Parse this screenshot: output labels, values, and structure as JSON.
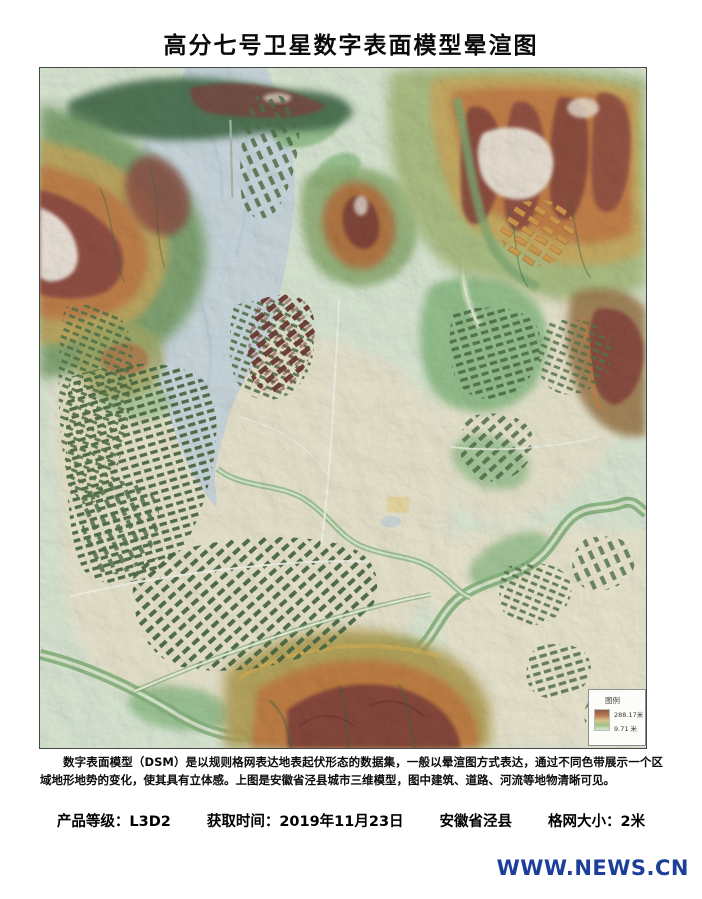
{
  "page": {
    "title": "高分七号卫星数字表面模型晕渲图",
    "watermark": "WWW.NEWS.CN"
  },
  "map": {
    "legend": {
      "title": "图例",
      "max_elevation": "288.17米",
      "min_elevation": "9.71 米"
    },
    "palette": {
      "base_green": "#d9e6d3",
      "water_blue": "#c9d7dd",
      "urban_beige": "#e8e3cd",
      "building_green": "#4d6b43",
      "mid_orange": "#c27c46",
      "high_maroon": "#8a4a42",
      "peak_white": "#efe9df"
    }
  },
  "description": "数字表面模型（DSM）是以规则格网表达地表起伏形态的数据集，一般以晕渲图方式表达，通过不同色带展示一个区域地形地势的变化，使其具有立体感。上图是安徽省泾县城市三维模型，图中建筑、道路、河流等地物清晰可见。",
  "info": [
    "产品等级：L3D2",
    "获取时间：2019年11月23日",
    "安徽省泾县",
    "格网大小：2米"
  ]
}
